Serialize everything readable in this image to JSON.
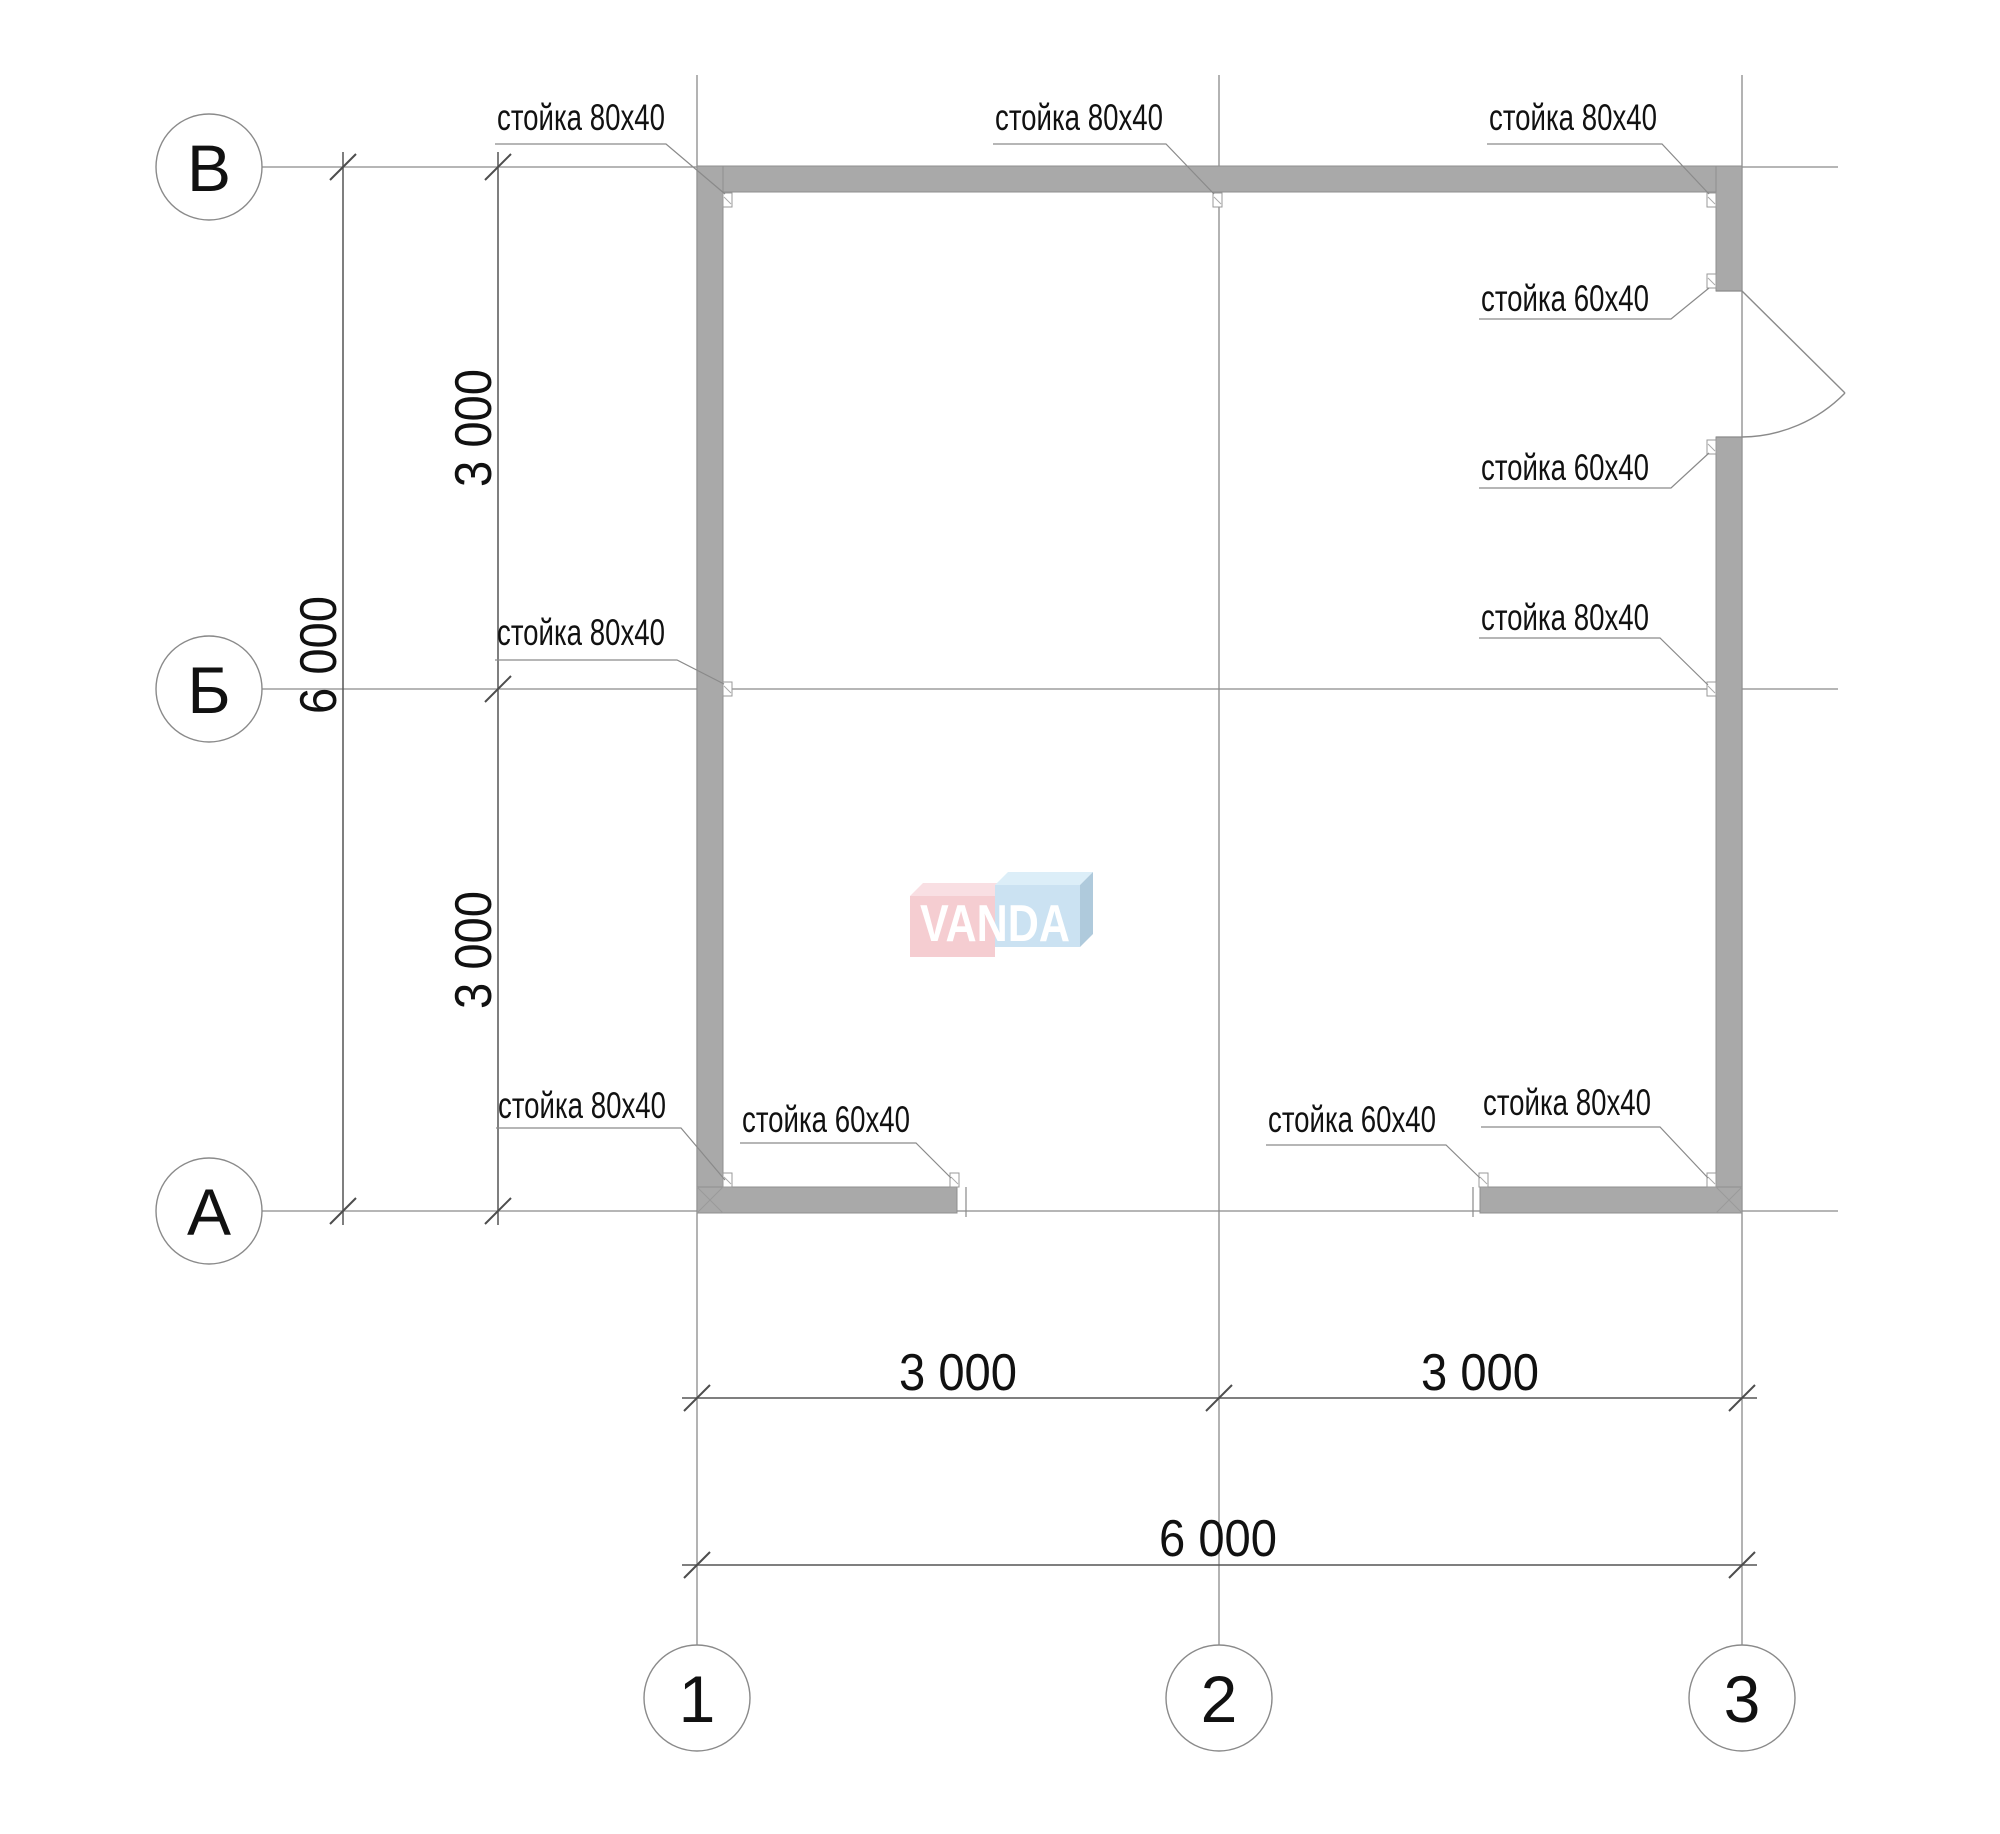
{
  "axes": {
    "rows": [
      "В",
      "Б",
      "А"
    ],
    "cols": [
      "1",
      "2",
      "3"
    ]
  },
  "dims": {
    "left_total": "6 000",
    "left_top": "3 000",
    "left_bottom": "3 000",
    "bottom_left": "3 000",
    "bottom_right": "3 000",
    "bottom_total": "6 000"
  },
  "labels": {
    "stud80": "стойка 80х40",
    "stud60": "стойка 60х40"
  },
  "watermark": {
    "text": "VANDA",
    "pink": "#f5c9ce",
    "pink_top": "#f9dde1",
    "blue": "#c7e0f1",
    "blue_top": "#daedf8",
    "blue_side": "#a9c6da"
  },
  "colors": {
    "wall_fill": "#a9a9a9",
    "wall_stroke": "#8f8f8f",
    "grid_line": "#8a8a8a",
    "dim_line": "#555555",
    "text": "#111111"
  }
}
